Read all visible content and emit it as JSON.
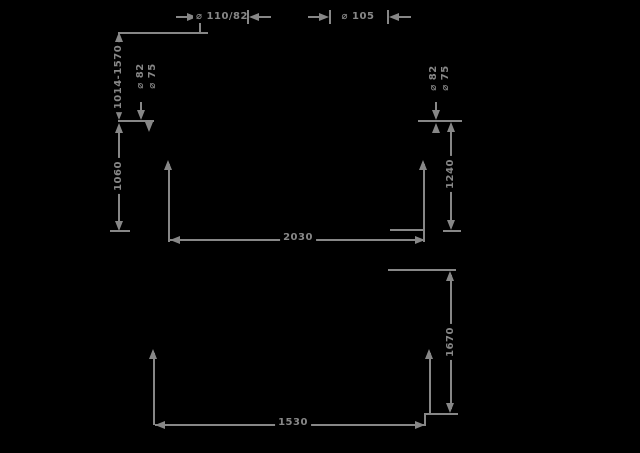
{
  "drawing": {
    "background": "#000000",
    "line_color": "#878787",
    "top_callouts": {
      "left": "⌀ 110/82",
      "right": "⌀ 105"
    },
    "upper_view": {
      "height_range": "1014-1570",
      "height_left": "1060",
      "height_right": "1240",
      "width": "2030",
      "pipe_callout_left": {
        "line1": "⌀ 82",
        "line2": "⌀ 75"
      },
      "pipe_callout_right": {
        "line1": "⌀ 82",
        "line2": "⌀ 75"
      }
    },
    "lower_view": {
      "height_right": "1670",
      "width": "1530"
    }
  }
}
